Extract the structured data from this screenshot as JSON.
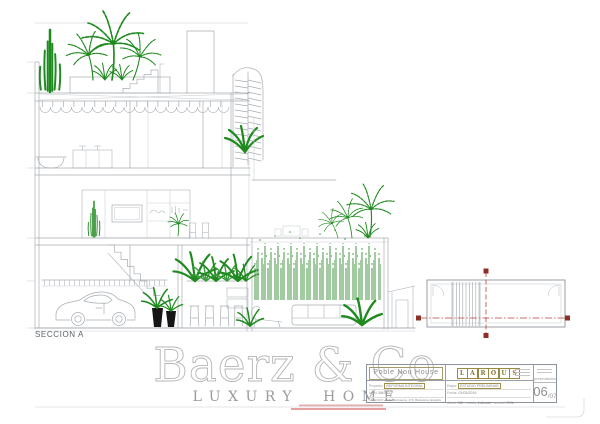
{
  "drawing": {
    "section_label": "SECCION A"
  },
  "watermark": {
    "brand": "Baerz & Co",
    "tagline": "LUXURY HOME"
  },
  "title_block": {
    "project_title": "Poble Nou House",
    "logo": {
      "letters": [
        "L",
        "A",
        "R",
        "O",
        "U",
        "S"
      ]
    },
    "fields_left": [
      {
        "label": "Proyecto:",
        "value": "REFORMA INTEGRAL"
      },
      {
        "label": "Nivel:",
        "value": "BASICO"
      },
      {
        "label": "Dirección:",
        "value": "Calle Marruecos, 170, Barcelona, España"
      }
    ],
    "fields_right": [
      {
        "label": "Etapa:",
        "value": "ESTUDIO PRELIMINAR"
      },
      {
        "label": "Fecha:",
        "value": "01/03/2019"
      }
    ],
    "meta_row": [
      {
        "label": "dibujó:",
        "value": "NA"
      },
      {
        "label": "escala:",
        "value": "indicada"
      },
      {
        "label": "aprobó:",
        "value": "RGL"
      }
    ],
    "presentation_label": "presentación",
    "sheet_number": "06",
    "sheet_total": "/07"
  },
  "key_plan": {
    "cut_line_color": "#b8443a",
    "marker_color": "#8e2f27"
  },
  "colors": {
    "linework": "#a7adb3",
    "plants": "#1f8a1f",
    "accent_olive": "#9a8a40",
    "watermark": "#b5b5b5"
  }
}
